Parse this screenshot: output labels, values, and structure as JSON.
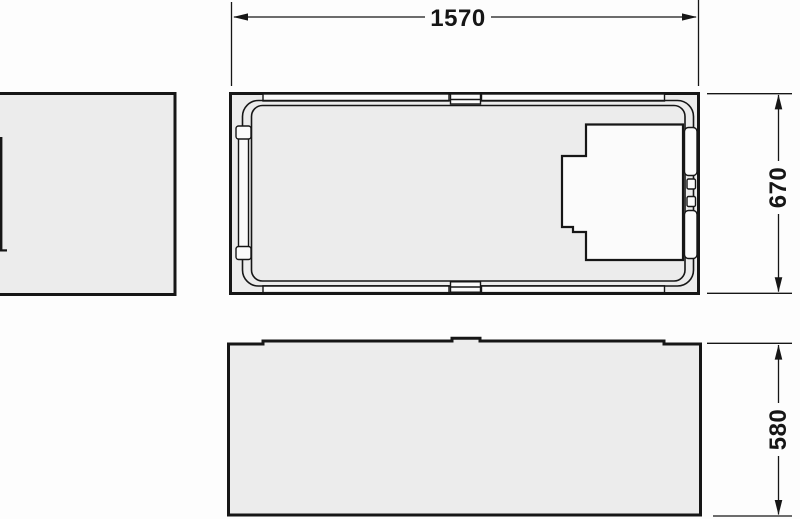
{
  "drawing": {
    "labels": {
      "width": "1570",
      "depth": "670",
      "height": "580"
    },
    "colors": {
      "line": "#161616",
      "fill": "#ececec",
      "cutout": "#fbfbfb",
      "background": "#fdfdfd"
    }
  }
}
